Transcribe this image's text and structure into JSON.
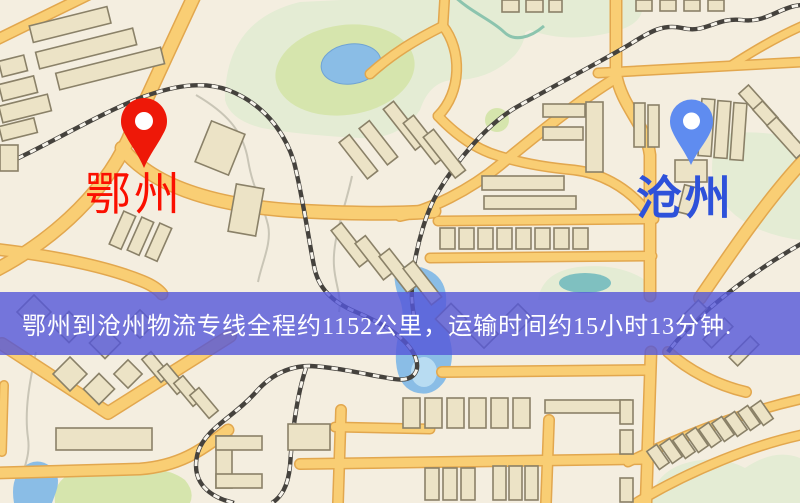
{
  "banner": {
    "text": "鄂州到沧州物流专线全程约1152公里，运输时间约15小时13分钟.",
    "background_color": "#5456da",
    "text_color": "#ffffff"
  },
  "origin": {
    "label": "鄂州",
    "marker_color": "#ee1808",
    "label_color": "#fb0f00"
  },
  "destination": {
    "label": "沧州",
    "marker_color": "#5f8cf0",
    "label_color": "#2e52da"
  },
  "map_colors": {
    "background": "#f4eee0",
    "road_fill": "#f9ce74",
    "road_casing": "#e2a74e",
    "park_green": "#e4ecd4",
    "water_blue": "#8abde6",
    "building_beige": "#ece3c6",
    "railway_dark": "#45423d"
  }
}
